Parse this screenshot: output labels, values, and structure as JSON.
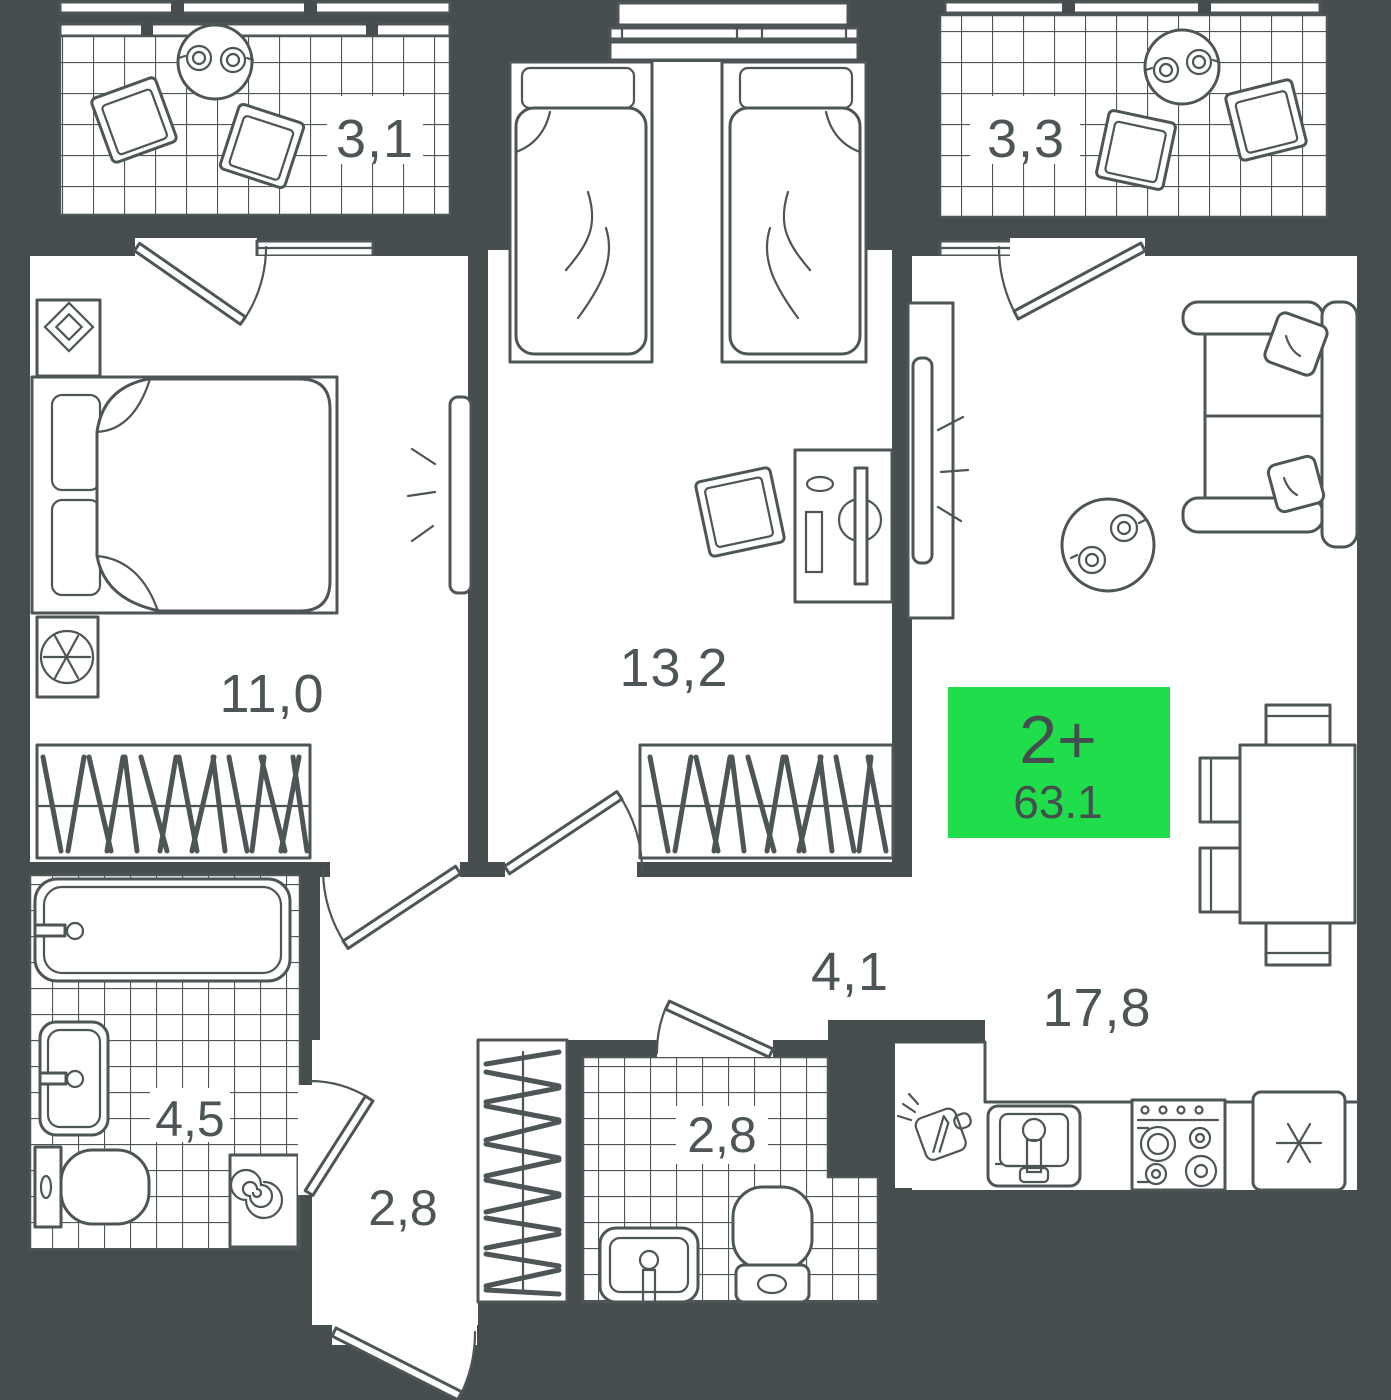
{
  "plan": {
    "unit_badge": {
      "type_label": "2+",
      "area_value": "63.1",
      "color": "#1fdd4b"
    },
    "rooms": [
      {
        "name": "balcony-top-left",
        "area_label": "3,1"
      },
      {
        "name": "balcony-top-right",
        "area_label": "3,3"
      },
      {
        "name": "bedroom-left",
        "area_label": "11,0"
      },
      {
        "name": "bedroom-middle",
        "area_label": "13,2"
      },
      {
        "name": "hallway",
        "area_label": "4,1"
      },
      {
        "name": "living-kitchen",
        "area_label": "17,8"
      },
      {
        "name": "bathroom-left",
        "area_label": "4,5"
      },
      {
        "name": "entry-corridor",
        "area_label": "2,8"
      },
      {
        "name": "bathroom-middle",
        "area_label": "2,8"
      }
    ],
    "colors": {
      "wall": "#454d4f",
      "line": "#4d5557",
      "floor": "#ffffff",
      "badge_green": "#1fdd4b",
      "label_text": "#4d5557"
    }
  }
}
